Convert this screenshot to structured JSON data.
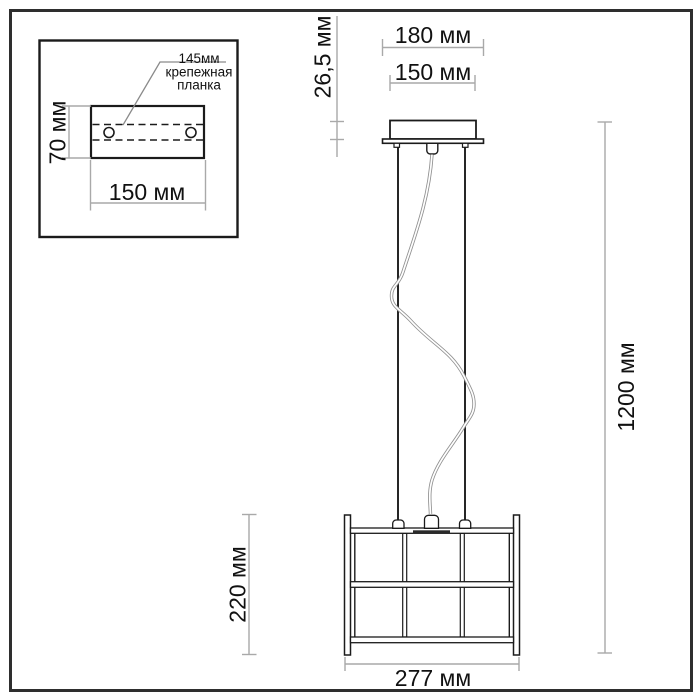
{
  "drawing": {
    "title_semantic": "pendant-lamp-dimension-drawing",
    "unit": "мм",
    "inset": {
      "note_line1": "145мм",
      "note_line2": "крепежная",
      "note_line3": "планка",
      "plate_height_label": "70 мм",
      "plate_width_label": "150 мм"
    },
    "dimensions": {
      "canopy_plate_width_label": "180 мм",
      "canopy_body_width_label": "150 мм",
      "canopy_height_label": "26,5 мм",
      "overall_height_label": "1200 мм",
      "shade_height_label": "220 мм",
      "shade_width_label": "277 мм"
    },
    "colors": {
      "line": "#1b1b1b",
      "dimension": "#a9a9a9",
      "background": "#ffffff",
      "frame": "#2e2e2e"
    }
  }
}
